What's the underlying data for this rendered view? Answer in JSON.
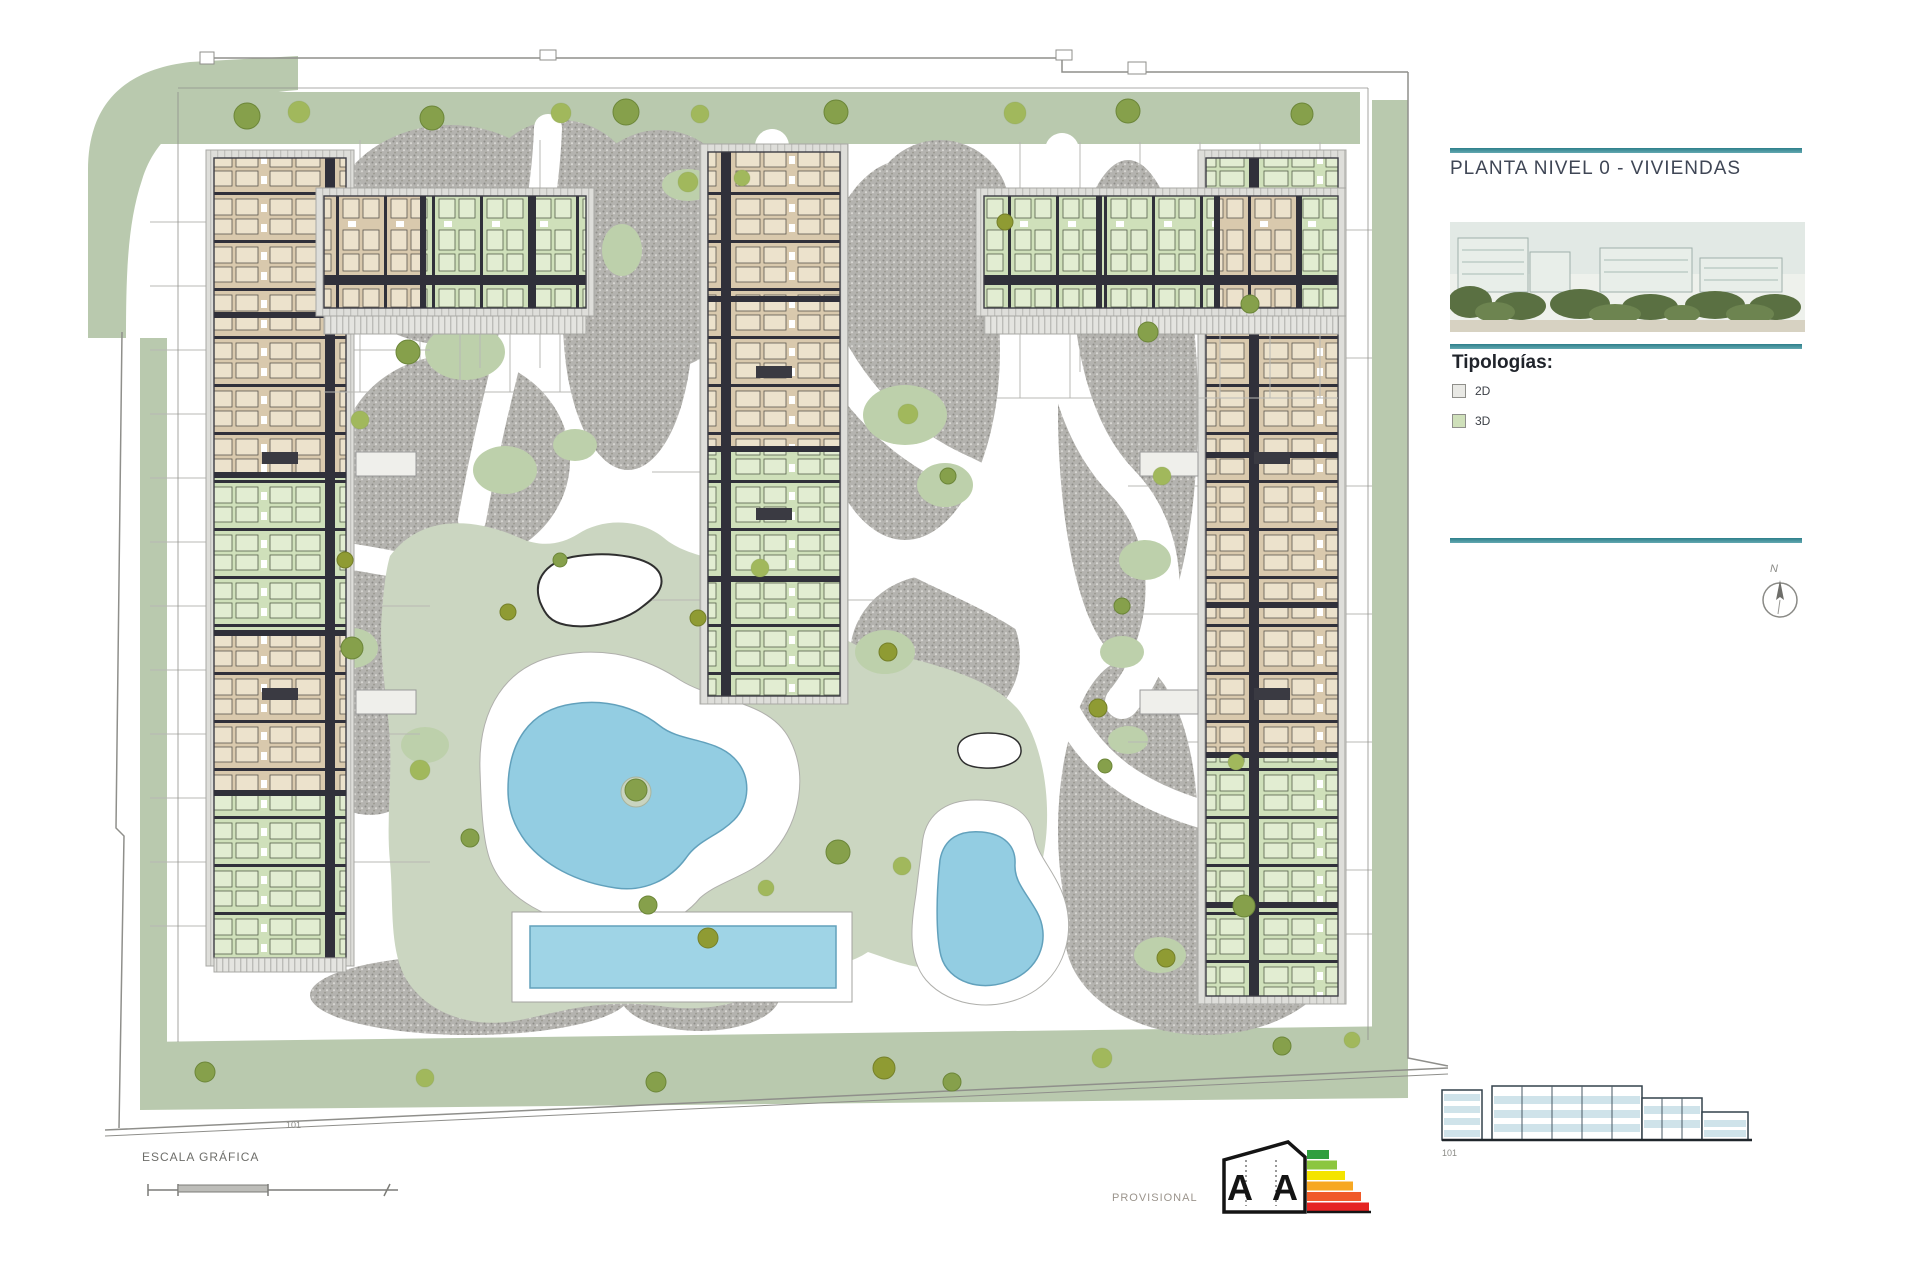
{
  "page": {
    "background": "#ffffff"
  },
  "sidebar": {
    "title": "PLANTA NIVEL 0 - VIVIENDAS",
    "rule_color": "#3d8d98",
    "legend_heading": "Tipologías:",
    "legend": [
      {
        "label": "2D",
        "swatch": "#e9e9e5",
        "border": "#8f8f8b"
      },
      {
        "label": "3D",
        "swatch": "#cfe0ba",
        "border": "#8f8f8b"
      }
    ],
    "compass_label": "N"
  },
  "plan": {
    "block_label": "101",
    "colors": {
      "verge_green": "#b9c9ae",
      "lawn_green": "#cbd6c1",
      "patch_green": "#bdd0ab",
      "gravel_gray": "#b2b1ad",
      "pool_blue": "#93cde2",
      "unit_tan": "#d9c9ad",
      "unit_green": "#cfe0ba",
      "wall_dark": "#30303a",
      "terrace_gray": "#dededa",
      "boundary_gray": "#8f8f8b"
    }
  },
  "footer": {
    "scale_label": "ESCALA GRÁFICA",
    "provisional_label": "PROVISIONAL",
    "energy_letters": [
      "A",
      "A"
    ],
    "energy_colors": [
      "#2f9e3f",
      "#8cc63f",
      "#f4e400",
      "#f7a823",
      "#f05a28",
      "#e52322"
    ],
    "elevation_label": "101"
  }
}
